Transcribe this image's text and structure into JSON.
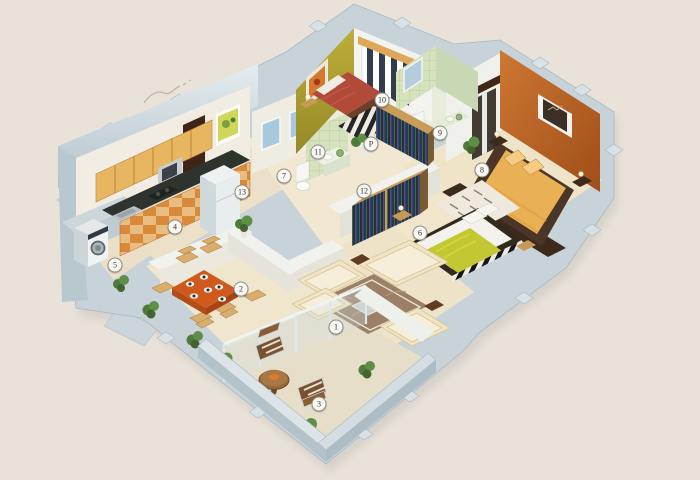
{
  "scene": {
    "background": "#e8e2d9",
    "marker_fill": "#f8f7f2",
    "marker_border": "#8e8d84",
    "marker_text": "#35342f"
  },
  "markers": [
    {
      "label": "1",
      "name": "marker-living-room",
      "x": 336,
      "y": 327
    },
    {
      "label": "2",
      "name": "marker-dining",
      "x": 241,
      "y": 289
    },
    {
      "label": "3",
      "name": "marker-balcony",
      "x": 319,
      "y": 404
    },
    {
      "label": "4",
      "name": "marker-kitchen",
      "x": 175,
      "y": 227
    },
    {
      "label": "5",
      "name": "marker-utility",
      "x": 115,
      "y": 265
    },
    {
      "label": "6",
      "name": "marker-bedroom-2",
      "x": 420,
      "y": 233
    },
    {
      "label": "7",
      "name": "marker-toilet",
      "x": 284,
      "y": 176
    },
    {
      "label": "8",
      "name": "marker-master-bedroom",
      "x": 482,
      "y": 170
    },
    {
      "label": "9",
      "name": "marker-bathroom",
      "x": 440,
      "y": 133
    },
    {
      "label": "10",
      "name": "marker-bedroom-3",
      "x": 382,
      "y": 100
    },
    {
      "label": "11",
      "name": "marker-wash-basin",
      "x": 318,
      "y": 152
    },
    {
      "label": "12",
      "name": "marker-passage",
      "x": 364,
      "y": 191
    },
    {
      "label": "13",
      "name": "marker-foyer",
      "x": 242,
      "y": 192
    },
    {
      "label": "P",
      "name": "marker-pooja",
      "x": 371,
      "y": 144
    }
  ],
  "palette": {
    "outer_wall": "#c8d3d9",
    "wall_top": "#dde4e8",
    "inner_wall": "#f1ede2",
    "floor": "#eee3c9",
    "olive_wall": "#b1a233",
    "orange_wall": "#c06020",
    "green_tile": "#d6e2bd",
    "blue_tile": "#a8c9dd",
    "bed_red": "#b24a3a",
    "bed_yellow": "#c3c731",
    "bed_orange": "#e9b055",
    "dining_table": "#d05a1e",
    "cabinet_wood": "#e8b661",
    "counter_dark": "#2f332d",
    "sofa_cream": "#f0e4c3",
    "rug_brown": "#9b8066",
    "door_brown": "#3f2517",
    "plant_green": "#4e7a3a"
  }
}
